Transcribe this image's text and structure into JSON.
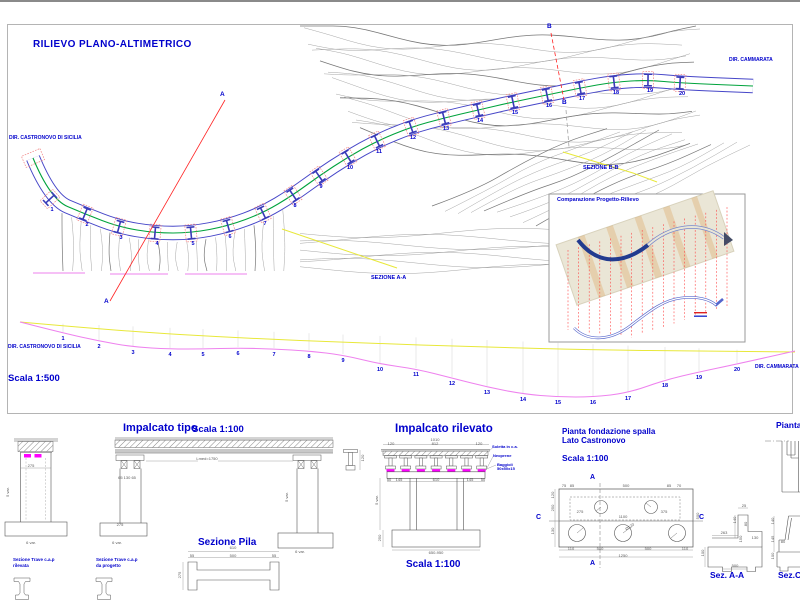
{
  "sheet": {
    "title": "RILIEVO PLANO-ALTIMETRICO",
    "scale_label": "Scala 1:500",
    "dir_left": "DIR. CASTRONOVO DI SICILIA",
    "dir_right": "DIR. CAMMARATA",
    "section_aa": "SEZIONE A-A",
    "section_bb": "SEZIONE B-B",
    "marker_a": "A",
    "marker_b": "B"
  },
  "plan": {
    "piers": [
      {
        "n": "1",
        "x": 50,
        "y": 199
      },
      {
        "n": "2",
        "x": 85,
        "y": 214
      },
      {
        "n": "3",
        "x": 119,
        "y": 227
      },
      {
        "n": "4",
        "x": 155,
        "y": 233
      },
      {
        "n": "5",
        "x": 191,
        "y": 233
      },
      {
        "n": "6",
        "x": 228,
        "y": 226
      },
      {
        "n": "7",
        "x": 263,
        "y": 213
      },
      {
        "n": "8",
        "x": 293,
        "y": 195
      },
      {
        "n": "9",
        "x": 319,
        "y": 176
      },
      {
        "n": "10",
        "x": 348,
        "y": 157
      },
      {
        "n": "11",
        "x": 377,
        "y": 141
      },
      {
        "n": "12",
        "x": 411,
        "y": 127
      },
      {
        "n": "13",
        "x": 444,
        "y": 118
      },
      {
        "n": "14",
        "x": 478,
        "y": 110
      },
      {
        "n": "15",
        "x": 513,
        "y": 102
      },
      {
        "n": "16",
        "x": 547,
        "y": 95
      },
      {
        "n": "17",
        "x": 580,
        "y": 88
      },
      {
        "n": "18",
        "x": 614,
        "y": 82
      },
      {
        "n": "19",
        "x": 648,
        "y": 80
      },
      {
        "n": "20",
        "x": 680,
        "y": 83
      }
    ]
  },
  "profile": {
    "stations": [
      {
        "n": "1",
        "x": 63,
        "y": 337
      },
      {
        "n": "2",
        "x": 99,
        "y": 345
      },
      {
        "n": "3",
        "x": 133,
        "y": 351
      },
      {
        "n": "4",
        "x": 170,
        "y": 353
      },
      {
        "n": "5",
        "x": 203,
        "y": 353
      },
      {
        "n": "6",
        "x": 238,
        "y": 352
      },
      {
        "n": "7",
        "x": 274,
        "y": 353
      },
      {
        "n": "8",
        "x": 309,
        "y": 355
      },
      {
        "n": "9",
        "x": 343,
        "y": 359
      },
      {
        "n": "10",
        "x": 380,
        "y": 368
      },
      {
        "n": "11",
        "x": 416,
        "y": 373
      },
      {
        "n": "12",
        "x": 452,
        "y": 382
      },
      {
        "n": "13",
        "x": 487,
        "y": 391
      },
      {
        "n": "14",
        "x": 523,
        "y": 398
      },
      {
        "n": "15",
        "x": 558,
        "y": 401
      },
      {
        "n": "16",
        "x": 593,
        "y": 401
      },
      {
        "n": "17",
        "x": 628,
        "y": 397
      },
      {
        "n": "18",
        "x": 665,
        "y": 384
      },
      {
        "n": "19",
        "x": 699,
        "y": 376
      },
      {
        "n": "20",
        "x": 737,
        "y": 368
      }
    ]
  },
  "inset": {
    "title": "Comparazione Progetto-Rilievo"
  },
  "details": {
    "impalcato_tipo": {
      "title": "Impalcato tipo",
      "scale": "Scala 1:100"
    },
    "impalcato_rilevato": {
      "title": "Impalcato rilevato",
      "scale": "Scala 1:100",
      "label_soletta": "Soletta in c.a.",
      "label_neoprene": "Neoprene",
      "label_baggioli_1": "Baggioli",
      "label_baggioli_2": "50x50x15"
    },
    "sezione_pila": {
      "title": "Sezione Pila"
    },
    "trave_rilevata": {
      "line1": "Sezione Trave c.a.p",
      "line2": "rilevata"
    },
    "trave_progetto": {
      "line1": "Sezione Trave c.a.p",
      "line2": "da progetto"
    },
    "fondazione": {
      "title_1": "Pianta fondazione spalla",
      "title_2": "Lato Castronovo",
      "scale": "Scala 1:100",
      "marker_a": "A",
      "marker_c": "C"
    },
    "pianta": {
      "title": "Pianta"
    },
    "sez_aa": {
      "title": "Sez. A-A"
    },
    "sez_c": {
      "title": "Sez.C"
    }
  },
  "dims": [
    {
      "t": "275",
      "x": 31,
      "y": 466
    },
    {
      "t": "5 var.",
      "x": 8,
      "y": 492,
      "r": -90
    },
    {
      "t": "6 var.",
      "x": 31,
      "y": 543
    },
    {
      "t": "Lmed=1750",
      "x": 207,
      "y": 459
    },
    {
      "t": "65 130 65",
      "x": 127,
      "y": 478
    },
    {
      "t": "275",
      "x": 120,
      "y": 525
    },
    {
      "t": "5 var.",
      "x": 287,
      "y": 497,
      "r": -90
    },
    {
      "t": "6 var.",
      "x": 117,
      "y": 543
    },
    {
      "t": "6 var.",
      "x": 300,
      "y": 552
    },
    {
      "t": "120",
      "x": 363,
      "y": 458,
      "r": -90
    },
    {
      "t": "610",
      "x": 233,
      "y": 548
    },
    {
      "t": "55",
      "x": 192,
      "y": 556
    },
    {
      "t": "500",
      "x": 233,
      "y": 556
    },
    {
      "t": "55",
      "x": 274,
      "y": 556
    },
    {
      "t": "275",
      "x": 180,
      "y": 575,
      "r": -90
    },
    {
      "t": "1010",
      "x": 435,
      "y": 440
    },
    {
      "t": "120",
      "x": 391,
      "y": 444
    },
    {
      "t": "812",
      "x": 435,
      "y": 444
    },
    {
      "t": "120",
      "x": 479,
      "y": 444
    },
    {
      "t": "50",
      "x": 389,
      "y": 480
    },
    {
      "t": "145",
      "x": 399,
      "y": 480
    },
    {
      "t": "610",
      "x": 436,
      "y": 480
    },
    {
      "t": "145",
      "x": 470,
      "y": 480
    },
    {
      "t": "50",
      "x": 483,
      "y": 480
    },
    {
      "t": "5 var.",
      "x": 377,
      "y": 500,
      "r": -90
    },
    {
      "t": "250",
      "x": 380,
      "y": 538,
      "r": -90
    },
    {
      "t": "650-950",
      "x": 436,
      "y": 553
    },
    {
      "t": "75",
      "x": 564,
      "y": 486
    },
    {
      "t": "85",
      "x": 572,
      "y": 486
    },
    {
      "t": "500",
      "x": 626,
      "y": 486
    },
    {
      "t": "85",
      "x": 669,
      "y": 486
    },
    {
      "t": "70",
      "x": 679,
      "y": 486
    },
    {
      "t": "120",
      "x": 553,
      "y": 495,
      "r": -90
    },
    {
      "t": "250",
      "x": 553,
      "y": 508,
      "r": -90
    },
    {
      "t": "130",
      "x": 553,
      "y": 531,
      "r": -90
    },
    {
      "t": "275",
      "x": 580,
      "y": 512
    },
    {
      "t": "1100",
      "x": 623,
      "y": 517
    },
    {
      "t": "375",
      "x": 664,
      "y": 512
    },
    {
      "t": "Ø120",
      "x": 630,
      "y": 527,
      "r": -35
    },
    {
      "t": "110",
      "x": 571,
      "y": 549
    },
    {
      "t": "500",
      "x": 600,
      "y": 549
    },
    {
      "t": "500",
      "x": 648,
      "y": 549
    },
    {
      "t": "110",
      "x": 685,
      "y": 549
    },
    {
      "t": "1250",
      "x": 623,
      "y": 556
    },
    {
      "t": "500",
      "x": 698,
      "y": 516,
      "r": -90
    },
    {
      "t": "25",
      "x": 744,
      "y": 506
    },
    {
      "t": "140",
      "x": 735,
      "y": 520,
      "r": -90
    },
    {
      "t": "80",
      "x": 746,
      "y": 524,
      "r": -90
    },
    {
      "t": "263",
      "x": 724,
      "y": 533
    },
    {
      "t": "150",
      "x": 741,
      "y": 539,
      "r": -90
    },
    {
      "t": "130",
      "x": 755,
      "y": 538
    },
    {
      "t": "100",
      "x": 703,
      "y": 553,
      "r": -90
    },
    {
      "t": "500",
      "x": 735,
      "y": 566
    },
    {
      "t": "140",
      "x": 773,
      "y": 521,
      "r": -90
    },
    {
      "t": "145",
      "x": 773,
      "y": 539,
      "r": -90
    },
    {
      "t": "80",
      "x": 783,
      "y": 542
    },
    {
      "t": "100",
      "x": 773,
      "y": 556,
      "r": -90
    }
  ],
  "colors": {
    "accent_blue": "#0000cc",
    "line_red": "#ff2222",
    "line_magenta": "#ee82ee",
    "line_green": "#00a33c",
    "line_yellow": "#e8e83a",
    "deck_blue": "#4646c8"
  }
}
